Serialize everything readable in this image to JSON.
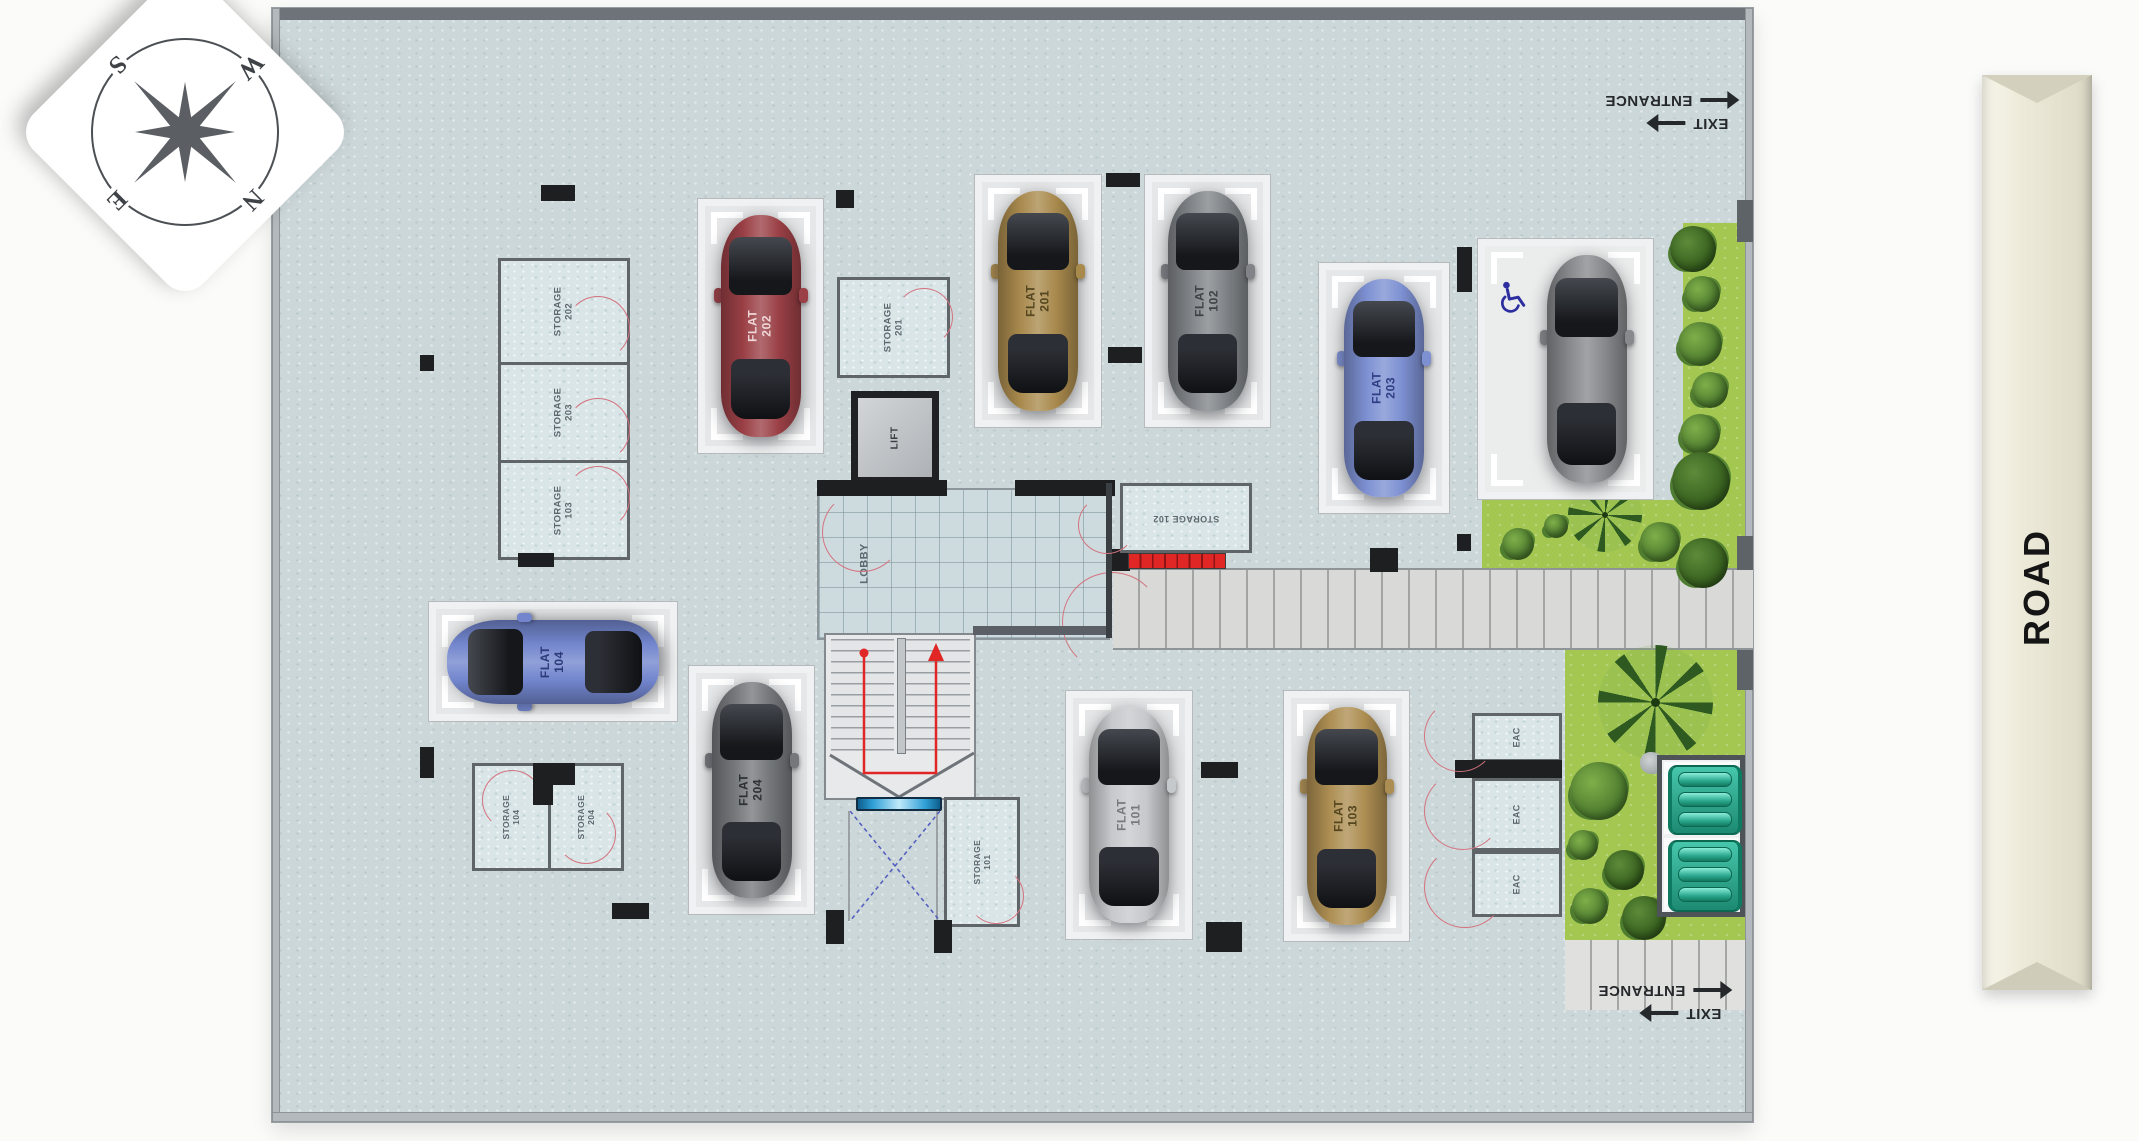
{
  "compass": {
    "n": "N",
    "e": "E",
    "s": "S",
    "w": "W"
  },
  "road": {
    "label": "ROAD"
  },
  "signs": {
    "exit": "EXIT",
    "entrance": "ENTRANCE"
  },
  "rooms": {
    "storage_202": "STORAGE\n202",
    "storage_203": "STORAGE\n203",
    "storage_103": "STORAGE\n103",
    "storage_201": "STORAGE\n201",
    "storage_102": "STORAGE 102",
    "storage_101": "STORAGE\n101",
    "storage_104": "STORAGE\n104",
    "storage_204": "STORAGE\n204",
    "lift": "LIFT",
    "lobby": "LOBBY",
    "eac": "EAC"
  },
  "parking": {
    "spots": [
      {
        "id": "flat-202",
        "label": "FLAT\n202",
        "car_color": "#9a4046",
        "label_color": "#efd7d8"
      },
      {
        "id": "flat-201",
        "label": "FLAT\n201",
        "car_color": "#a98a4d",
        "label_color": "#55461f"
      },
      {
        "id": "flat-102",
        "label": "FLAT\n102",
        "car_color": "#808488",
        "label_color": "#3e4347"
      },
      {
        "id": "flat-203",
        "label": "FLAT\n203",
        "car_color": "#7d90d2",
        "label_color": "#2f3e84"
      },
      {
        "id": "accessible",
        "label": "",
        "car_color": "#87898c",
        "label_color": "#3e4347"
      },
      {
        "id": "flat-104",
        "label": "FLAT\n104",
        "car_color": "#7285cd",
        "label_color": "#2c3a7a"
      },
      {
        "id": "flat-204",
        "label": "FLAT\n204",
        "car_color": "#75787b",
        "label_color": "#2e3134"
      },
      {
        "id": "flat-101",
        "label": "FLAT\n101",
        "car_color": "#c6c9cb",
        "label_color": "#77797c"
      },
      {
        "id": "flat-103",
        "label": "FLAT\n103",
        "car_color": "#ad8e52",
        "label_color": "#55461f"
      }
    ]
  },
  "colors": {
    "floor": "#ccd7d9",
    "garden": "#a3c751",
    "door_arc": "#d4737f",
    "stair_accent": "#e12626",
    "tank": "#2aa78d",
    "road_sign": "#ece9d8"
  }
}
